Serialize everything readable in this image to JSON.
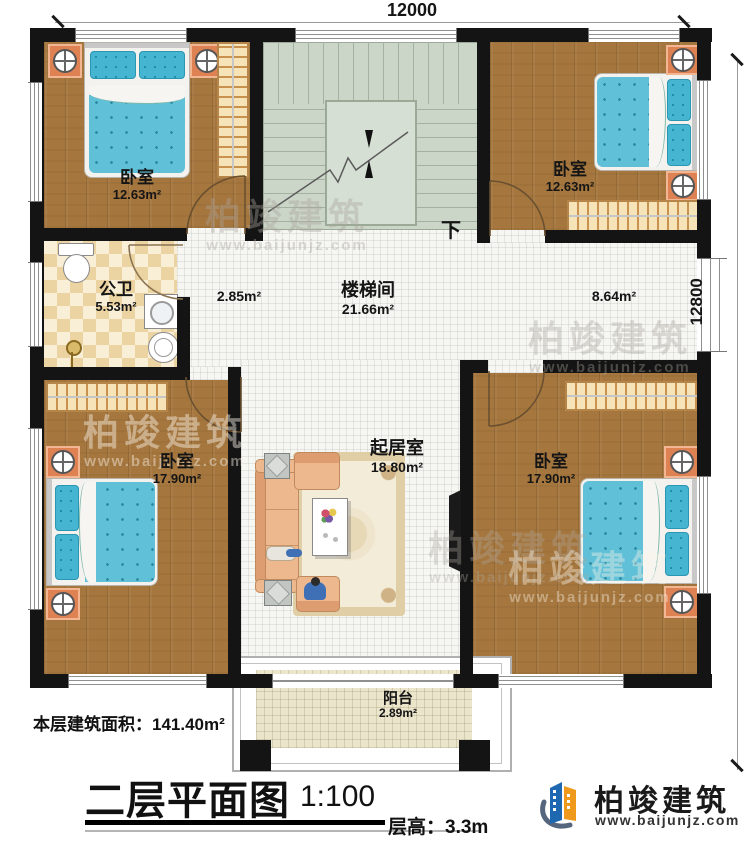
{
  "dimensions": {
    "width_top": "12000",
    "height_right": "12800"
  },
  "rooms": {
    "bedroom_tl": {
      "name": "卧室",
      "area": "12.63m²"
    },
    "bedroom_tr": {
      "name": "卧室",
      "area": "12.63m²"
    },
    "stairwell": {
      "name": "楼梯间",
      "area": "21.66m²"
    },
    "bathroom": {
      "name": "公卫",
      "area": "5.53m²"
    },
    "hall": {
      "area": "2.85m²"
    },
    "corridor": {
      "area": "8.64m²"
    },
    "living_room": {
      "name": "起居室",
      "area": "18.80m²"
    },
    "bedroom_bl": {
      "name": "卧室",
      "area": "17.90m²"
    },
    "bedroom_br": {
      "name": "卧室",
      "area": "17.90m²"
    },
    "balcony": {
      "name": "阳台",
      "area": "2.89m²"
    },
    "stairs_direction": "下"
  },
  "footer": {
    "floor_area": "本层建筑面积：141.40m²",
    "title": "二层平面图",
    "scale": "1:100",
    "floor_height": "层高：3.3m"
  },
  "brand": {
    "name": "柏竣建筑",
    "website": "www.baijunjz.com"
  },
  "colors": {
    "wall": "#141414",
    "wood_floor": "#a5763d",
    "tile_floor": "#f6f6f3",
    "stair_floor": "#cbd6c9",
    "mattress_blue": "#5fc0d8",
    "nightstand_orange": "#df8253",
    "logo_blue": "#1e68b2",
    "logo_orange": "#f09a1d"
  }
}
